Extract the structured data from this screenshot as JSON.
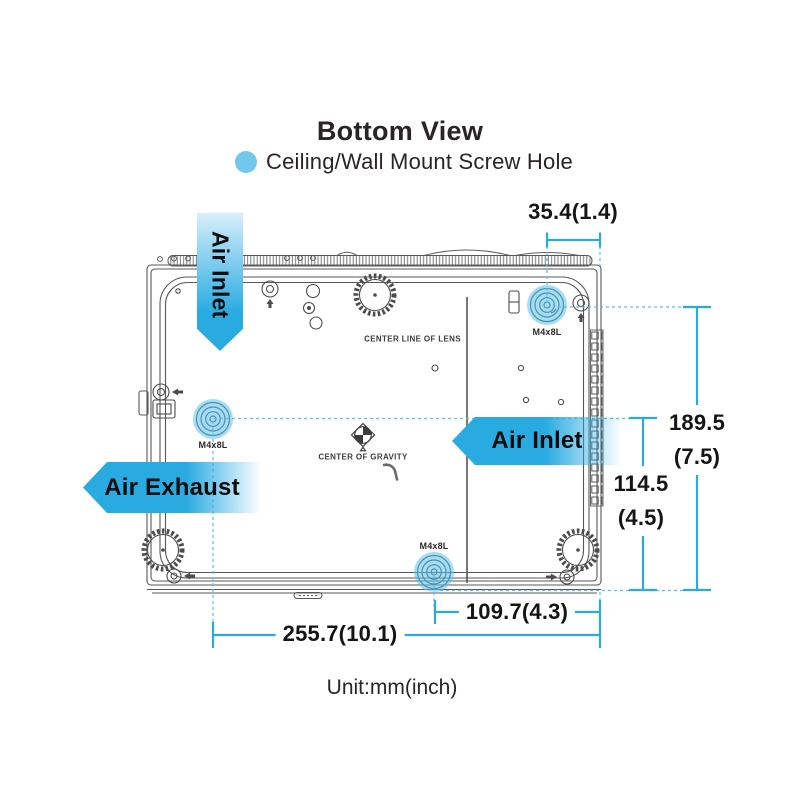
{
  "title": "Bottom View",
  "legend": {
    "label": "Ceiling/Wall Mount Screw Hole",
    "dot_color": "#72C7EC"
  },
  "arrows": {
    "air_inlet_top": "Air Inlet",
    "air_inlet_right": "Air Inlet",
    "air_exhaust": "Air Exhaust"
  },
  "drawing_labels": {
    "center_line_of_lens": "CENTER LINE OF LENS",
    "center_of_gravity": "CENTER OF GRAVITY",
    "screw_top_right": "M4x8L",
    "screw_mid_left": "M4x8L",
    "screw_bottom": "M4x8L"
  },
  "dimensions": {
    "top_offset": "35.4(1.4)",
    "right_outer_mm": "189.5",
    "right_outer_inch": "(7.5)",
    "right_inner_mm": "114.5",
    "right_inner_inch": "(4.5)",
    "bottom_inner": "109.7(4.3)",
    "bottom_outer": "255.7(10.1)"
  },
  "footer": {
    "unit_note": "Unit:mm(inch)"
  },
  "colors": {
    "accent": "#29ABE2",
    "accent_dashed": "#56C2EA",
    "highlight": "rgba(90,195,238,0.55)",
    "line_art": "#58585A",
    "text": "#231F20"
  }
}
